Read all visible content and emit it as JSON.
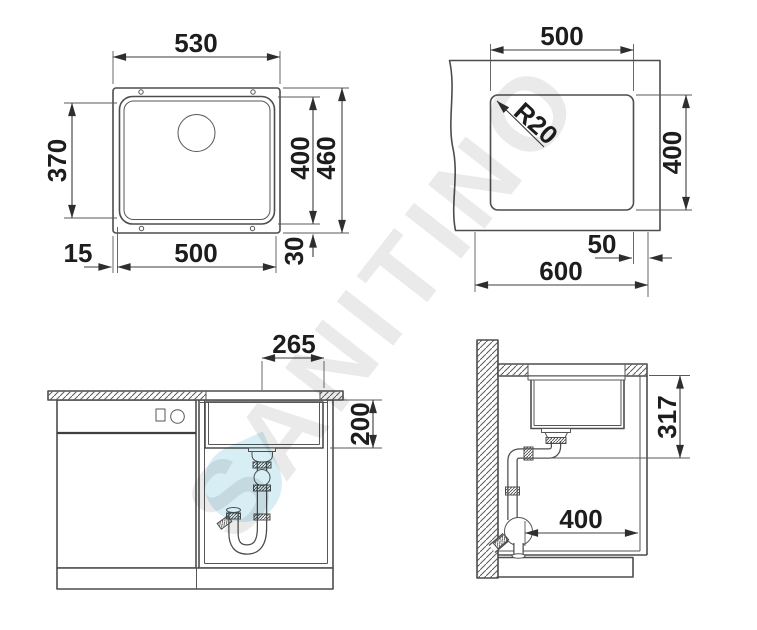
{
  "watermark": {
    "text": "SANITINO"
  },
  "colors": {
    "line": "#4d4d4d",
    "dimension_line": "#3c3c3c",
    "dimension_text": "#1d1d1d",
    "watermark_gray": "rgba(60,60,60,0.11)",
    "watermark_teal": "rgba(73,177,203,0.22)"
  },
  "views": {
    "top": {
      "label": "sink top view",
      "dim_width_outer": "530",
      "dim_inner_left": "370",
      "dim_bowl_height": "400",
      "dim_outer_height": "460",
      "dim_bowl_width": "500",
      "dim_flange_left": "15",
      "dim_flange_bottom": "30"
    },
    "cutout": {
      "label": "countertop cutout view",
      "dim_width": "500",
      "dim_radius": "R20",
      "dim_height": "400",
      "dim_edge": "50",
      "dim_total": "600"
    },
    "front": {
      "label": "cabinet front view",
      "dim_drain_offset": "265",
      "dim_bowl_depth": "200"
    },
    "side": {
      "label": "cabinet side section",
      "dim_height": "317",
      "dim_depth": "400"
    }
  }
}
